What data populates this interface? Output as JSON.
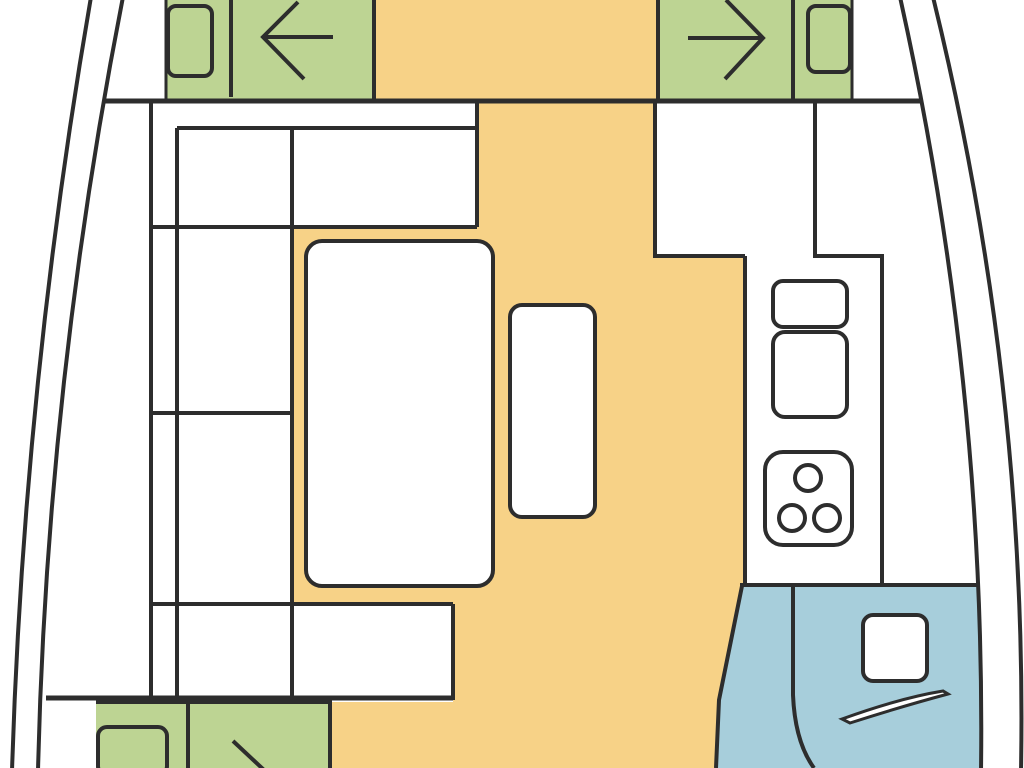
{
  "colors": {
    "background": "#ffffff",
    "line": "#2d2d2d",
    "floor": "#f7d287",
    "cabin": "#bdd493",
    "bath": "#a7cedb",
    "furniture": "#ffffff"
  },
  "diagram": {
    "type": "boat-floor-plan",
    "orientation": "bow-at-top, stern-at-bottom (cropped mid-section)",
    "text_labels": [],
    "areas": {
      "forward_cabin_left": {
        "fill": "cabin",
        "items": [
          "pillow",
          "mattress-divider",
          "arrow-pointing-left"
        ]
      },
      "forward_cabin_right": {
        "fill": "cabin",
        "items": [
          "pillow",
          "mattress-divider",
          "arrow-pointing-right"
        ]
      },
      "aft_cabin_left": {
        "fill": "cabin",
        "items": [
          "pillow",
          "mattress-divider",
          "partial-arrow"
        ]
      },
      "salon": {
        "fill": "floor",
        "items": [
          "u-shaped-settee",
          "dining-table",
          "center-bench"
        ]
      },
      "galley": {
        "fill": "furniture",
        "items": [
          "l-shaped-counter",
          "small-sink",
          "large-sink",
          "stove-with-3-burners"
        ]
      },
      "head_compartment": {
        "fill": "bath",
        "items": [
          "door-swing-line",
          "washbasin-square",
          "seat-sliver"
        ]
      },
      "hull": {
        "style": "double-curved-outline",
        "sides": [
          "left",
          "right"
        ]
      }
    }
  }
}
